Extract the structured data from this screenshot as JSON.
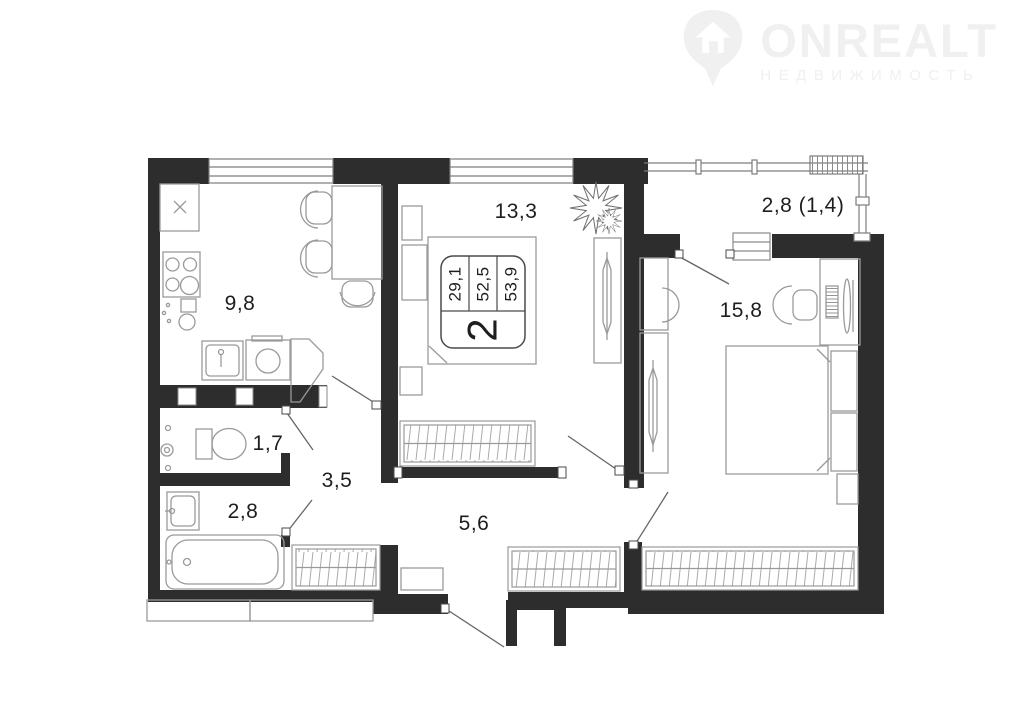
{
  "logo": {
    "brand": "ONREALT",
    "tagline": "НЕДВИЖИМОСТЬ"
  },
  "plan": {
    "rooms": {
      "kitchen": "9,8",
      "living": "13,3",
      "balcony": "2,8 (1,4)",
      "bedroom": "15,8",
      "wc": "1,7",
      "hall": "3,5",
      "bath": "2,8",
      "corridor": "5,6"
    },
    "info_box": {
      "rooms_count": "2",
      "values": [
        "29,1",
        "52,5",
        "53,9"
      ]
    }
  },
  "colors": {
    "wall": "#2d2d2d",
    "furniture_stroke": "#9a9a9a",
    "door_line": "#666666",
    "label_text": "#1e1e1e",
    "watermark": "#f0f0f0"
  }
}
